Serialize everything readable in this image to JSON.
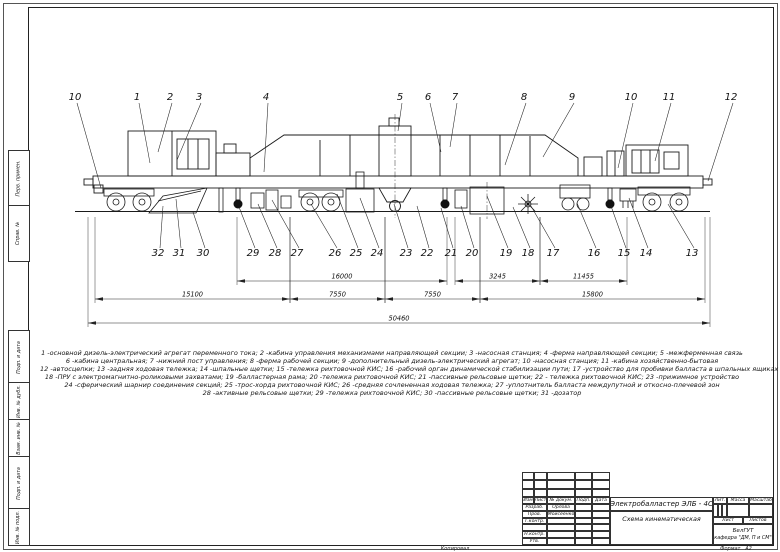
{
  "drawing": {
    "top_callouts": [
      {
        "n": "10",
        "x": 75,
        "y": 100,
        "tx": 101,
        "ty": 188
      },
      {
        "n": "1",
        "x": 137,
        "y": 100,
        "tx": 150,
        "ty": 163
      },
      {
        "n": "2",
        "x": 170,
        "y": 100,
        "tx": 158,
        "ty": 152
      },
      {
        "n": "3",
        "x": 199,
        "y": 100,
        "tx": 177,
        "ty": 160
      },
      {
        "n": "4",
        "x": 266,
        "y": 100,
        "tx": 264,
        "ty": 172
      },
      {
        "n": "5",
        "x": 400,
        "y": 100,
        "tx": 398,
        "ty": 131
      },
      {
        "n": "6",
        "x": 428,
        "y": 100,
        "tx": 441,
        "ty": 152
      },
      {
        "n": "7",
        "x": 455,
        "y": 100,
        "tx": 450,
        "ty": 147
      },
      {
        "n": "8",
        "x": 524,
        "y": 100,
        "tx": 505,
        "ty": 165
      },
      {
        "n": "9",
        "x": 572,
        "y": 100,
        "tx": 543,
        "ty": 157
      },
      {
        "n": "10",
        "x": 631,
        "y": 100,
        "tx": 618,
        "ty": 168
      },
      {
        "n": "11",
        "x": 669,
        "y": 100,
        "tx": 655,
        "ty": 161
      },
      {
        "n": "12",
        "x": 731,
        "y": 100,
        "tx": 708,
        "ty": 181
      }
    ],
    "bottom_callouts": [
      {
        "n": "32",
        "x": 158,
        "y": 256,
        "tx": 163,
        "ty": 206
      },
      {
        "n": "31",
        "x": 179,
        "y": 256,
        "tx": 176,
        "ty": 199
      },
      {
        "n": "30",
        "x": 203,
        "y": 256,
        "tx": 193,
        "ty": 212
      },
      {
        "n": "29",
        "x": 253,
        "y": 256,
        "tx": 239,
        "ty": 207
      },
      {
        "n": "28",
        "x": 275,
        "y": 256,
        "tx": 258,
        "ty": 204
      },
      {
        "n": "27",
        "x": 297,
        "y": 256,
        "tx": 272,
        "ty": 200
      },
      {
        "n": "26",
        "x": 335,
        "y": 256,
        "tx": 311,
        "ty": 204
      },
      {
        "n": "25",
        "x": 356,
        "y": 256,
        "tx": 337,
        "ty": 194
      },
      {
        "n": "24",
        "x": 377,
        "y": 256,
        "tx": 360,
        "ty": 198
      },
      {
        "n": "23",
        "x": 406,
        "y": 256,
        "tx": 394,
        "ty": 204
      },
      {
        "n": "22",
        "x": 427,
        "y": 256,
        "tx": 417,
        "ty": 206
      },
      {
        "n": "21",
        "x": 451,
        "y": 256,
        "tx": 441,
        "ty": 208
      },
      {
        "n": "20",
        "x": 472,
        "y": 256,
        "tx": 461,
        "ty": 206
      },
      {
        "n": "19",
        "x": 506,
        "y": 256,
        "tx": 487,
        "ty": 196
      },
      {
        "n": "18",
        "x": 528,
        "y": 256,
        "tx": 513,
        "ty": 207
      },
      {
        "n": "17",
        "x": 553,
        "y": 256,
        "tx": 531,
        "ty": 206
      },
      {
        "n": "16",
        "x": 594,
        "y": 256,
        "tx": 577,
        "ty": 203
      },
      {
        "n": "15",
        "x": 624,
        "y": 256,
        "tx": 611,
        "ty": 206
      },
      {
        "n": "14",
        "x": 646,
        "y": 256,
        "tx": 629,
        "ty": 198
      },
      {
        "n": "13",
        "x": 692,
        "y": 256,
        "tx": 668,
        "ty": 204
      }
    ],
    "dimension_rows": [
      {
        "y": 281,
        "segs": [
          {
            "x1": 237,
            "x2": 447,
            "label": "16000"
          },
          {
            "x1": 455,
            "x2": 540,
            "label": "3245"
          },
          {
            "x1": 540,
            "x2": 627,
            "label": "11455"
          }
        ]
      },
      {
        "y": 299,
        "segs": [
          {
            "x1": 95,
            "x2": 290,
            "label": "15100"
          },
          {
            "x1": 290,
            "x2": 385,
            "label": "7550"
          },
          {
            "x1": 385,
            "x2": 480,
            "label": "7550"
          },
          {
            "x1": 480,
            "x2": 705,
            "label": "15800"
          }
        ]
      },
      {
        "y": 323,
        "segs": [
          {
            "x1": 88,
            "x2": 710,
            "label": "50460"
          }
        ]
      }
    ],
    "legend_lines": [
      "1 -основной дизель-электрический агрегат переменного тока; 2 -кабина управления механизмами направляющей секции; 3 -насосная станция; 4 -ферма направляющей секции; 5 -межферменная связь",
      "6 -кабина центральная; 7 -нижний пост управления; 8 -ферма рабочей секции; 9 -дополнительный дизель-электрический агрегат; 10 -насосная станция; 11 -кабина хозяйственно-бытовая",
      "12 -автосцепки; 13 -задняя ходовая тележка; 14 -шпальные щетки; 15 -тележка рихтовочной КИС; 16 -рабочий орган динамической стабилизации пути; 17 -устройство для пробивки балласта в шпальных ящиках",
      "18 -ПРУ с электромагнитно-роликовыми захватами; 19 -балластерная рама; 20 -тележка рихтовочной КИС; 21 -пассивные рельсовые щетки; 22 - тележка рихтовочной КИС; 23 -прижимное устройство",
      "24 -сферический шарнир соединения секций; 25 -трос-хорда рихтовочной КИС; 26 -средняя сочлененная ходовая тележка; 27 -уплотнитель балласта междупутной и откосно-плечевой зон",
      "28 -активные рельсовые щетки; 29 -тележка рихтовочной КИС; 30 -пассивные рельсовые щетки; 31 -дозатор"
    ]
  },
  "frame_labels": [
    {
      "text": "Перв. примен.",
      "y1": 150,
      "y2": 205
    },
    {
      "text": "Справ. №",
      "y1": 205,
      "y2": 260
    },
    {
      "text": "Подп. и дата",
      "y1": 330,
      "y2": 382
    },
    {
      "text": "Инв. № дубл.",
      "y1": 382,
      "y2": 419
    },
    {
      "text": "Взам. инв. №",
      "y1": 419,
      "y2": 456
    },
    {
      "text": "Подп. и дата",
      "y1": 456,
      "y2": 508
    },
    {
      "text": "Инв. № подл.",
      "y1": 508,
      "y2": 544
    }
  ],
  "title_block": {
    "title": "Электробалластер ЭЛБ - 4С",
    "subtitle": "Схема кинематическая",
    "cols": {
      "izm": "Изм",
      "list": "Лист",
      "doc": "№ докум.",
      "podp": "Подп.",
      "data": "Дата"
    },
    "roles": [
      {
        "label": "Разраб.",
        "name": "Орлова"
      },
      {
        "label": "Пров.",
        "name": "Моисеенко"
      },
      {
        "label": "Т.контр.",
        "name": ""
      },
      {
        "label": "",
        "name": ""
      },
      {
        "label": "Н.контр.",
        "name": ""
      },
      {
        "label": "Утв.",
        "name": ""
      }
    ],
    "lit_label": "Лит.",
    "mass_label": "Масса",
    "scale_label": "Масштаб",
    "sheet_label": "Лист",
    "sheets_label": "Листов",
    "org": "БелГУТ",
    "dept": "кафедра \"ДМ, П и СМ\"",
    "kopiroval": "Копировал",
    "format_label": "Формат",
    "format_value": "А2"
  }
}
